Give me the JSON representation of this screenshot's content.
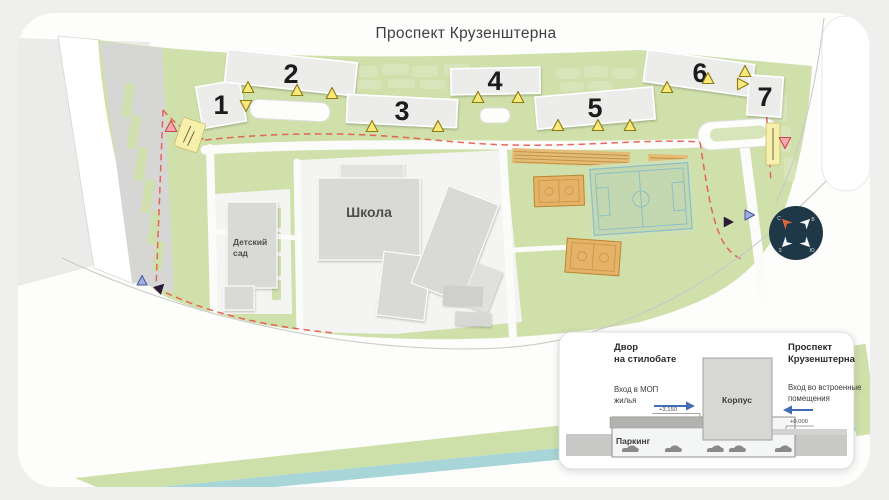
{
  "street": {
    "name": "Проспект Крузенштерна"
  },
  "buildings": [
    {
      "label": "1"
    },
    {
      "label": "2"
    },
    {
      "label": "3"
    },
    {
      "label": "4"
    },
    {
      "label": "5"
    },
    {
      "label": "6"
    },
    {
      "label": "7"
    }
  ],
  "labels": {
    "school": "Школа",
    "kindergarten_line1": "Детский",
    "kindergarten_line2": "сад"
  },
  "compass": {
    "north": "С",
    "east": "В",
    "south": "Ю",
    "west": "З"
  },
  "inset": {
    "left_title_line1": "Двор",
    "left_title_line2": "на стилобате",
    "right_title_line1": "Проспект",
    "right_title_line2": "Крузенштерна",
    "left_note_line1": "Вход в МОП",
    "left_note_line2": "жилья",
    "right_note_line1": "Вход во встроенные",
    "right_note_line2": "помещения",
    "building_label": "Корпус",
    "parking_label": "Паркинг",
    "elevation_yard": "+3,150",
    "elevation_street": "+0,000"
  },
  "colors": {
    "background": "#eff0ee",
    "road_white": "#ffffff",
    "green_main": "#cfe0ab",
    "green_light": "#dbe6c3",
    "building_gray": "#ececea",
    "school_gray": "#d9d9d7",
    "court_orange": "#e5b268",
    "field_green": "#c3d8b0",
    "boundary_red": "#e4584e",
    "marker_yellow": "#f9e87a",
    "marker_pink": "#f4a9b0",
    "marker_blue": "#9fb0dd",
    "marker_dark": "#2e1838",
    "compass_navy": "#1f3847",
    "arrow_blue": "#3f6db5",
    "accent_teal": "#a8d5d8"
  }
}
